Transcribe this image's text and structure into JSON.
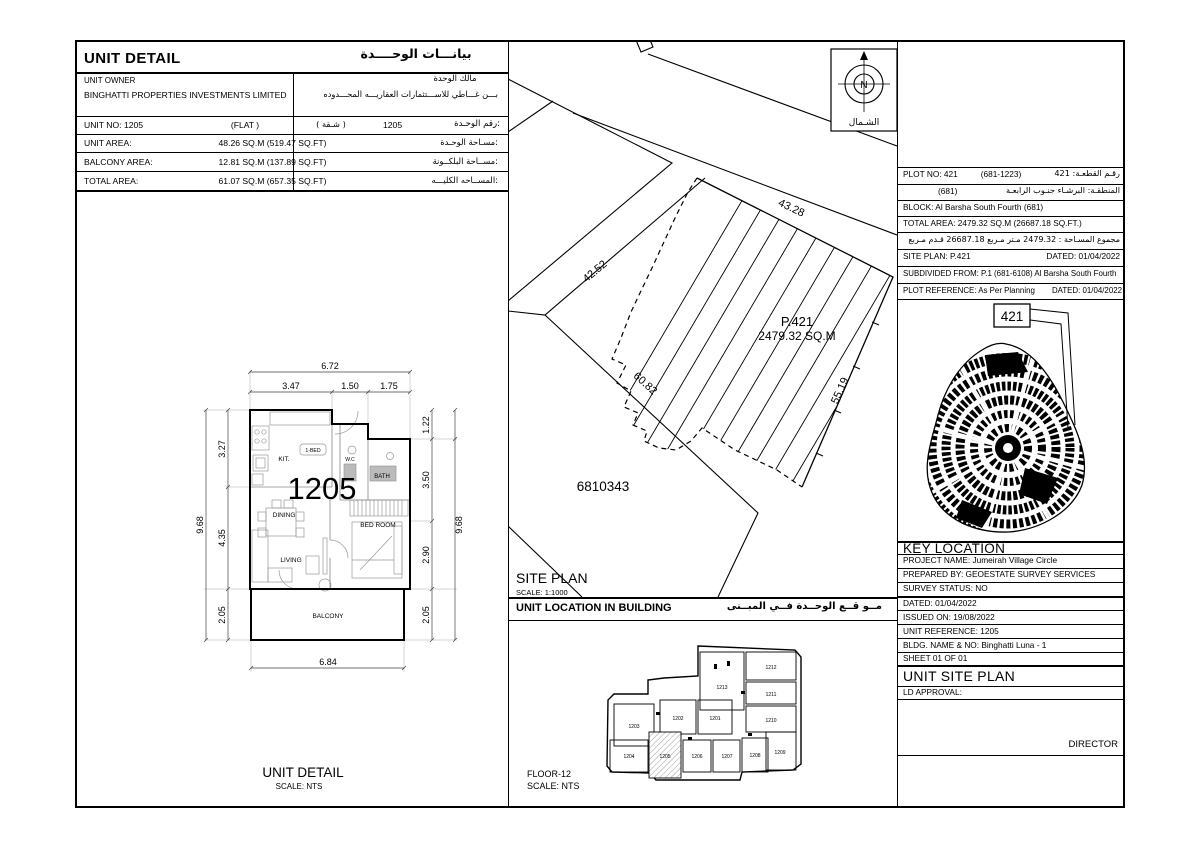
{
  "unit_detail": {
    "title_en": "UNIT DETAIL",
    "title_ar": "بيانـــات الوحــــدة",
    "owner_label_en": "UNIT OWNER",
    "owner_name_en": "BINGHATTI PROPERTIES INVESTMENTS LIMITED",
    "owner_label_ar": "مالك الوحدة",
    "owner_name_ar": "بـــن غـــاطي للاســـتثمارات العقاريـــه المحـــدوده",
    "unit_no_en": "UNIT NO: 1205",
    "unit_type_en": "(FLAT )",
    "unit_type_ar": "( شـقة )",
    "unit_no_value": "1205",
    "unit_no_label_ar": "رقم الوحـدة:",
    "area_rows": [
      {
        "label_en": "UNIT AREA:",
        "value": "48.26 SQ.M (519.47 SQ.FT)",
        "label_ar": "مسـاحة الوحـدة:"
      },
      {
        "label_en": "BALCONY AREA:",
        "value": "12.81 SQ.M (137.89 SQ.FT)",
        "label_ar": "مســاحة البلكــونة:"
      },
      {
        "label_en": "TOTAL AREA:",
        "value": "61.07 SQ.M (657.35 SQ.FT)",
        "label_ar": "المســاحه الكليـــه:"
      }
    ]
  },
  "floor_plan": {
    "unit_number": "1205",
    "rooms": {
      "kitchen": "KIT.",
      "bed_tag": "1-BED",
      "wc": "W.C",
      "bath": "BATH",
      "dining": "DINING",
      "living": "LIVING",
      "bedroom": "BED ROOM",
      "balcony": "BALCONY"
    },
    "dims": {
      "top_total": "6.72",
      "top_1": "3.47",
      "top_2": "1.50",
      "top_3": "1.75",
      "left_total": "9.68",
      "left_1": "3.27",
      "left_2": "4.35",
      "left_3": "2.05",
      "right_total": "9.68",
      "right_1": "1.22",
      "right_2": "3.50",
      "right_3": "2.90",
      "right_4": "2.05",
      "bottom": "6.84"
    },
    "title": "UNIT DETAIL",
    "scale": "SCALE: NTS"
  },
  "site_plan": {
    "labels": {
      "plot": "P.421",
      "area": "2479.32 SQ.M",
      "neighbor": "6810343",
      "edge_top": "43.28",
      "edge_right": "55.19",
      "edge_bottom": "60.82",
      "edge_road": "42.52"
    },
    "title": "SITE PLAN",
    "scale": "SCALE: 1:1000",
    "compass": {
      "n": "N",
      "north_ar": "الشـمال"
    }
  },
  "plot_table": {
    "plot_no_en": "PLOT NO: 421",
    "plot_no_mid": "(681-1223)",
    "plot_no_ar": "رقـم القطعـة:  421",
    "district_ar": "المنطقـة: البرشـاء جنـوب الرابعـة",
    "district_paren": "(681)",
    "block_en": "BLOCK: Al Barsha South Fourth  (681)",
    "total_area_en": "TOTAL AREA:   2479.32 SQ.M   (26687.18 SQ.FT.)",
    "total_area_ar": "مجموع المسـاحة :  2479.32  مـتر مـربع      26687.18  قـدم مـربع",
    "site_plan_en": "SITE PLAN:  P.421",
    "site_plan_dated": "DATED:  01/04/2022",
    "subdivided_en": "SUBDIVIDED FROM:  P.1 (681-6108) Al Barsha South Fourth",
    "reference_en": "PLOT REFERENCE: As Per Planning",
    "reference_dated": "DATED: 01/04/2022"
  },
  "key_map": {
    "plot_label": "421"
  },
  "key_location": {
    "title": "KEY LOCATION",
    "rows": [
      "PROJECT NAME:  Jumeirah Village Circle",
      "PREPARED BY:  GEOESTATE SURVEY SERVICES",
      "SURVEY STATUS:  NO",
      "DATED:  01/04/2022",
      "ISSUED ON: 19/08/2022",
      "UNIT REFERENCE:  1205",
      "BLDG. NAME & NO: Binghatti Luna - 1",
      "SHEET 01 OF 01"
    ],
    "section_title": "UNIT SITE PLAN",
    "ld_approval": "LD APPROVAL:",
    "director": "DIRECTOR"
  },
  "building_plan": {
    "header_en": "UNIT LOCATION IN BUILDING",
    "header_ar": "مــو قــع الوحــدة  فــي المبــنى",
    "floor": "FLOOR-12",
    "scale": "SCALE:  NTS",
    "units": [
      "1201",
      "1202",
      "1203",
      "1204",
      "1205",
      "1206",
      "1207",
      "1208",
      "1209",
      "1210",
      "1211",
      "1212",
      "1213"
    ],
    "highlighted_unit": "1205"
  }
}
